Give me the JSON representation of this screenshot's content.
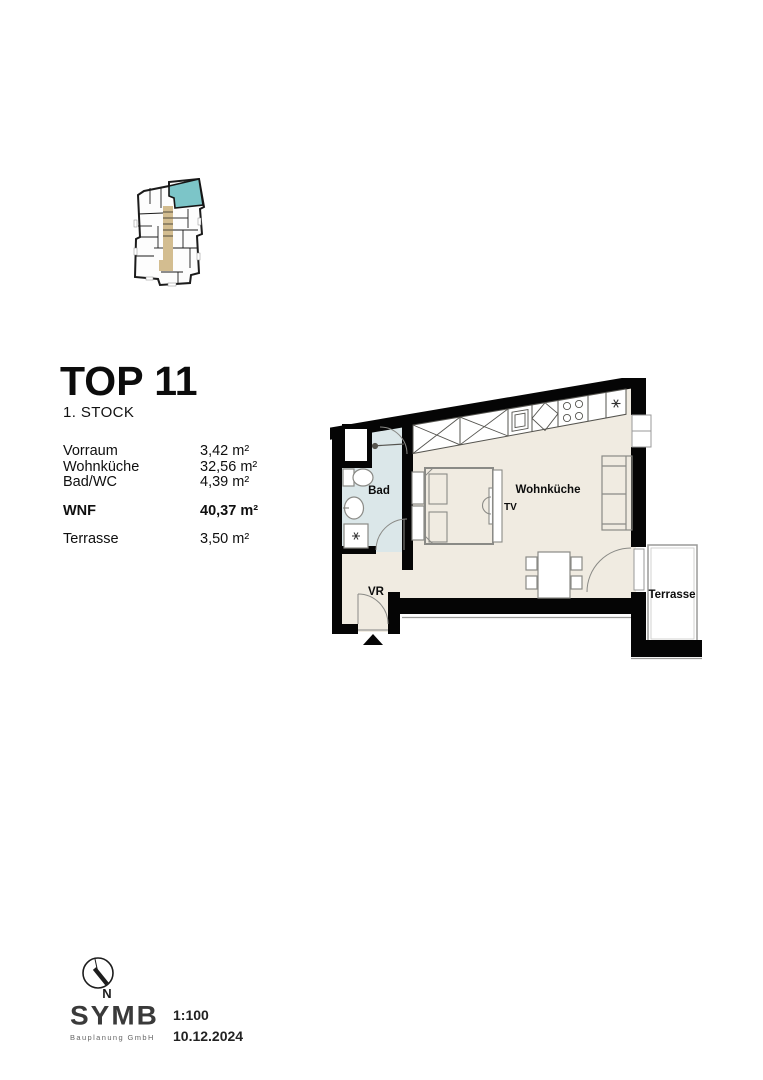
{
  "header": {
    "title": "TOP 11",
    "floor": "1. STOCK"
  },
  "areas": {
    "rows": [
      {
        "label": "Vorraum",
        "value": "3,42 m²"
      },
      {
        "label": "Wohnküche",
        "value": "32,56 m²"
      },
      {
        "label": "Bad/WC",
        "value": "4,39 m²"
      }
    ],
    "total_row": {
      "label": "WNF",
      "value": "40,37 m²"
    },
    "terrace_row": {
      "label": "Terrasse",
      "value": "3,50 m²"
    }
  },
  "floorplan": {
    "labels": {
      "bad": "Bad",
      "vr": "VR",
      "wohnkueche": "Wohnküche",
      "terrasse": "Terrasse",
      "tv": "TV"
    },
    "symbols": {
      "washing_machine": "asterisk-star",
      "kitchen_appliance": "asterisk-star",
      "cooktop": "four-burner-circles",
      "entrance_marker": "black-triangle"
    },
    "colors": {
      "wall": "#050505",
      "floor": "#f0ebe1",
      "bath_floor": "#dbe7e9",
      "furniture_line": "#8a8a86",
      "terrace_line": "#9a9a98"
    }
  },
  "overview": {
    "colors": {
      "outline": "#1b1b1b",
      "highlight_unit": "#7cc5c8",
      "corridor": "#d3bd90"
    }
  },
  "footer": {
    "north": "N",
    "logo": "SYMB",
    "logo_sub": "Bauplanung GmbH",
    "scale": "1:100",
    "date": "10.12.2024"
  }
}
